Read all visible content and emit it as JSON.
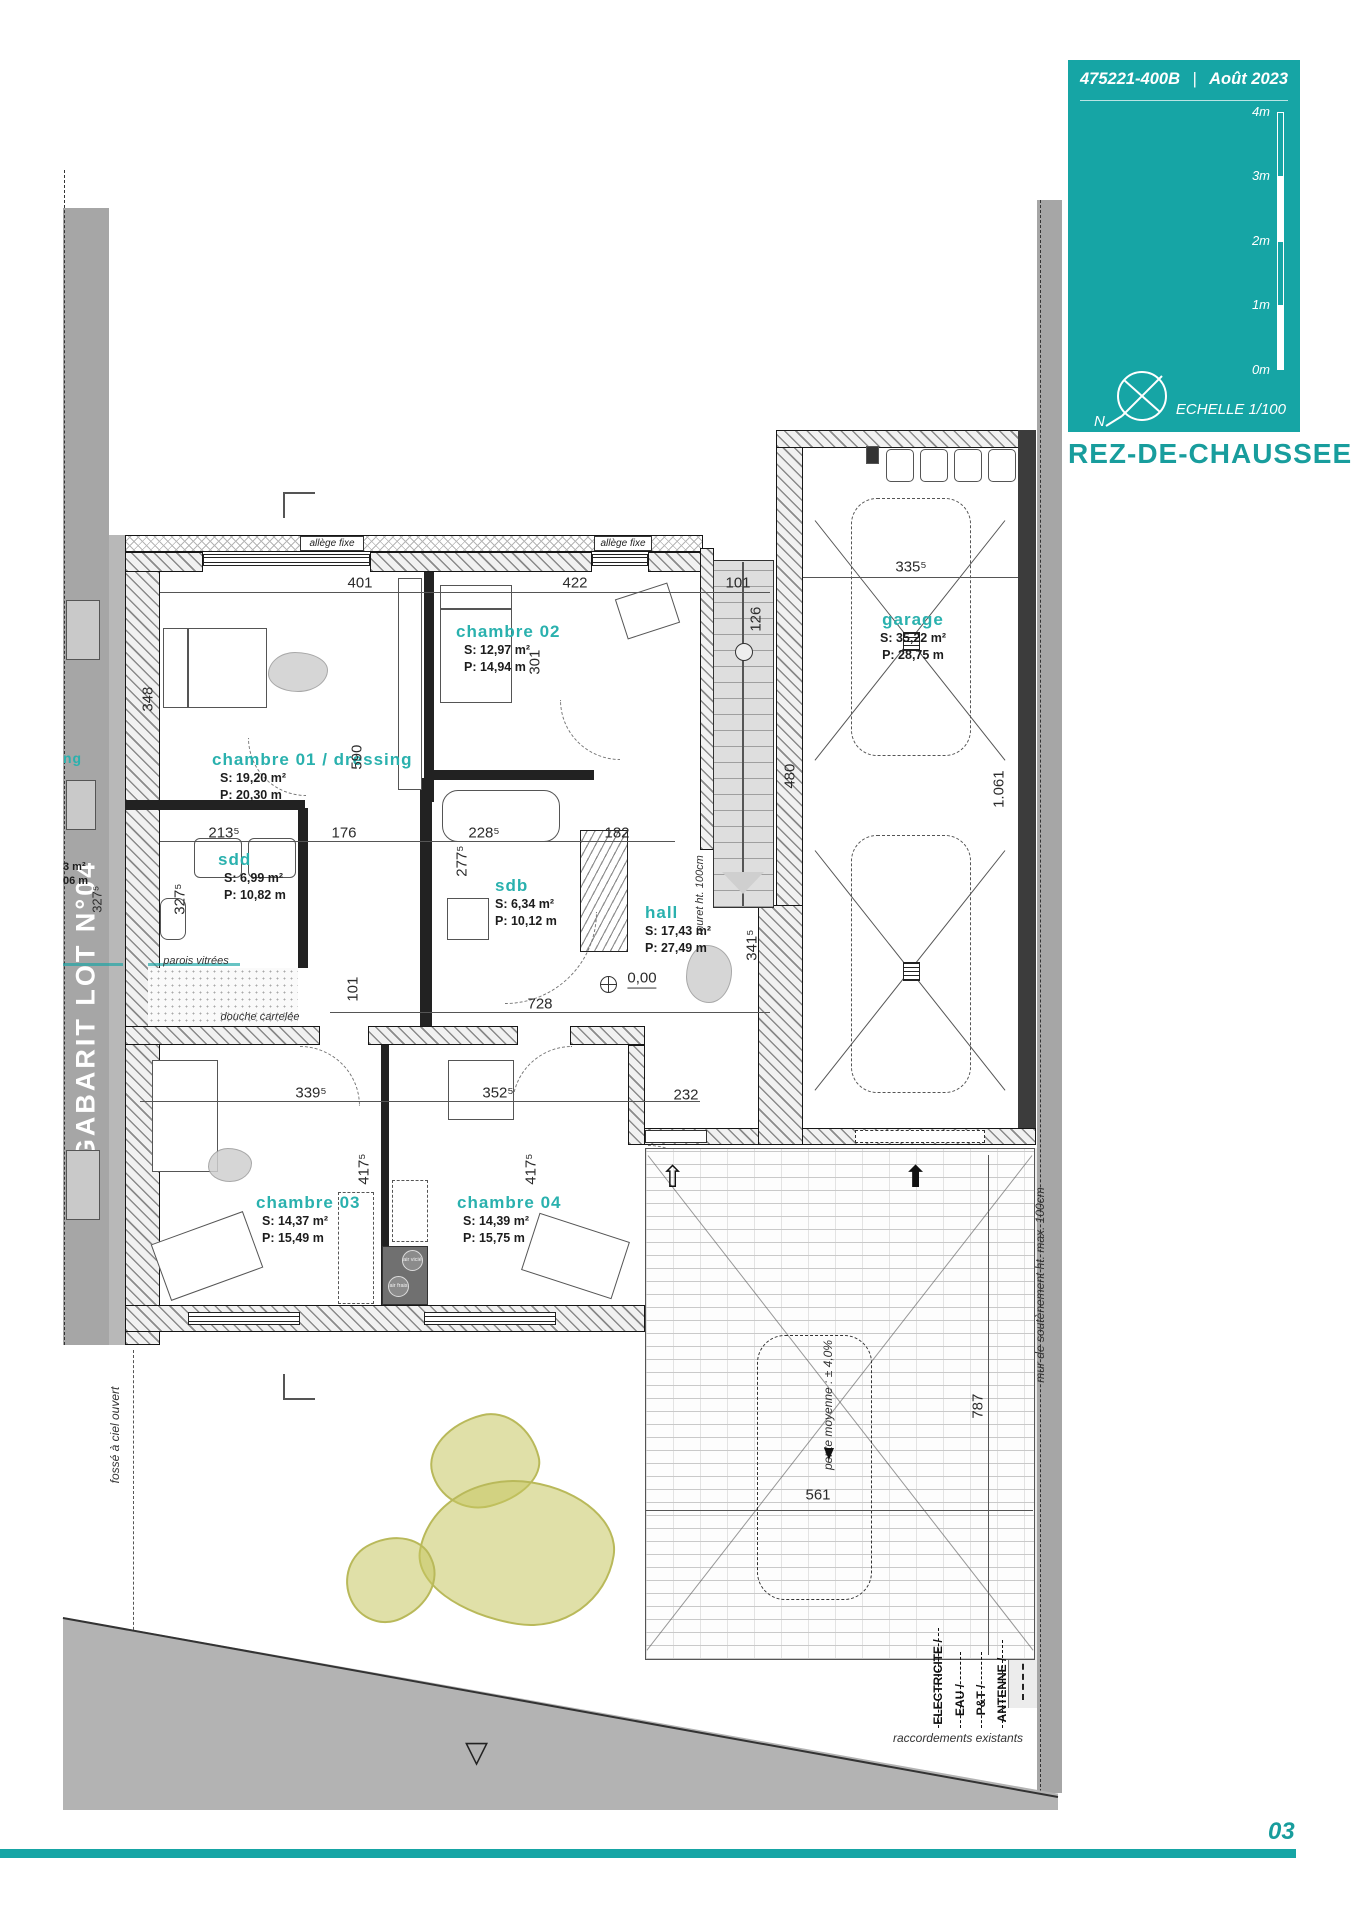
{
  "meta": {
    "doc_ref": "475221-400B",
    "separator": "|",
    "date": "Août 2023",
    "scale_label": "ECHELLE 1/100",
    "floor_title": "REZ-DE-CHAUSSEE",
    "page_number": "03",
    "north_letter": "N"
  },
  "scale_bar": {
    "labels": [
      "4m",
      "3m",
      "2m",
      "1m",
      "0m"
    ]
  },
  "gabarit_label": "GABARIT LOT N°04",
  "neighbor": {
    "partial_name": "ng",
    "partial_s": "3 m²",
    "partial_p": "06 m"
  },
  "rooms": [
    {
      "name": "chambre 01 / dressing",
      "s": "S: 19,20 m²",
      "p": "P: 20,30 m"
    },
    {
      "name": "chambre 02",
      "s": "S: 12,97 m²",
      "p": "P: 14,94 m"
    },
    {
      "name": "sdd",
      "s": "S: 6,99 m²",
      "p": "P: 10,82 m"
    },
    {
      "name": "sdb",
      "s": "S: 6,34 m²",
      "p": "P: 10,12 m"
    },
    {
      "name": "hall",
      "s": "S: 17,43 m²",
      "p": "P: 27,49 m"
    },
    {
      "name": "chambre 03",
      "s": "S: 14,37 m²",
      "p": "P: 15,49 m"
    },
    {
      "name": "chambre 04",
      "s": "S: 14,39 m²",
      "p": "P: 15,75 m"
    },
    {
      "name": "garage",
      "s": "S: 35,22 m²",
      "p": "P: 28,75 m"
    }
  ],
  "dimensions": {
    "d401": "401",
    "d422": "422",
    "d101_top": "101",
    "d126": "126",
    "d335": "335⁵",
    "d590": "590",
    "d301": "301",
    "d480": "480",
    "d348": "348",
    "d213": "213⁵",
    "d176": "176",
    "d228": "228⁵",
    "d182": "182",
    "d277": "277⁵",
    "d327_sdd": "327⁵",
    "d327_lot": "327⁵",
    "d101_hall": "101",
    "d728": "728",
    "d339": "339⁵",
    "d352": "352⁵",
    "d232": "232",
    "d417_c3": "417⁵",
    "d417_c4": "417⁵",
    "d341": "341⁵",
    "d1061": "1.061",
    "d787": "787",
    "d561": "561",
    "level": "0,00"
  },
  "annotations": {
    "allege_fixe": "allège fixe",
    "parois_vitrees": "parois vitrées",
    "douche_carrelee": "douche carrelée",
    "muret": "muret ht. 100cm",
    "mur_soutenement": "mur de soutènement ht. max. 100cm",
    "fosse_ciel": "fossé à ciel ouvert",
    "pente": "pente moyenne : ± 4,0%",
    "air_vicie": "air vicié",
    "air_frais": "air frais"
  },
  "utilities": {
    "items": [
      "ELECTRICITE /",
      "EAU /",
      "P&T /",
      "ANTENNE /"
    ],
    "note": "raccordements existants"
  },
  "colors": {
    "teal": "#16a5a5",
    "olive": "#c6c660",
    "gray_band": "#a6a6a6"
  }
}
